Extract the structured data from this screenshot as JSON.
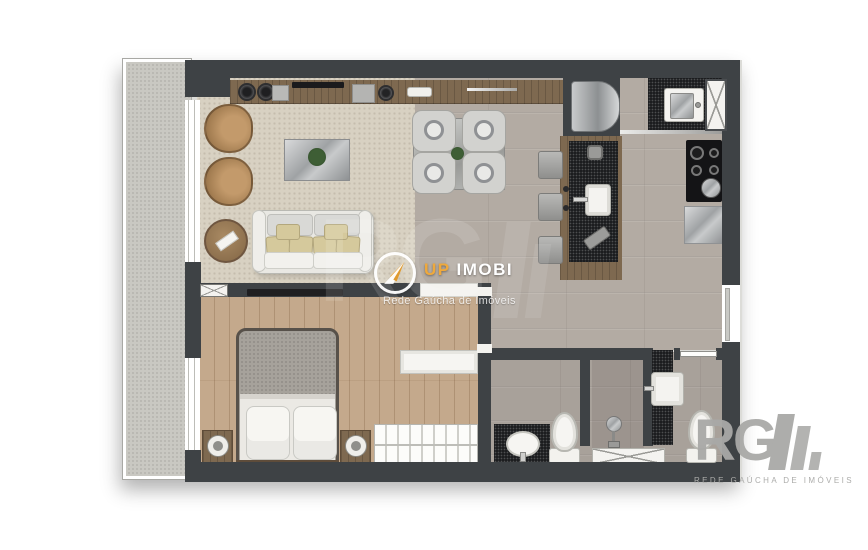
{
  "watermark": {
    "brand_up": "UP",
    "brand_imobi": "IMOBI",
    "tagline": "Rede Gaúcha de Imóveis"
  },
  "corner_logo": {
    "letters": "RG",
    "tagline": "REDE GAÚCHA DE IMÓVEIS"
  },
  "background_watermark": {
    "letters": "RG"
  },
  "colors": {
    "wall": "#3E4245",
    "balcony_floor": "#C9C8C2",
    "rug": "#D8D1C2",
    "tile": "#B3ABA3",
    "bath_tile": "#A8A19A",
    "bedroom_wood": "#C4A98C",
    "wood": "#7E6950",
    "stone": "#1B1C1E",
    "fixture_white": "#F4F3F0",
    "metal": "#BDBFC1",
    "brand_accent": "#EFA93C",
    "logo_grey": "#A9A9A7"
  }
}
